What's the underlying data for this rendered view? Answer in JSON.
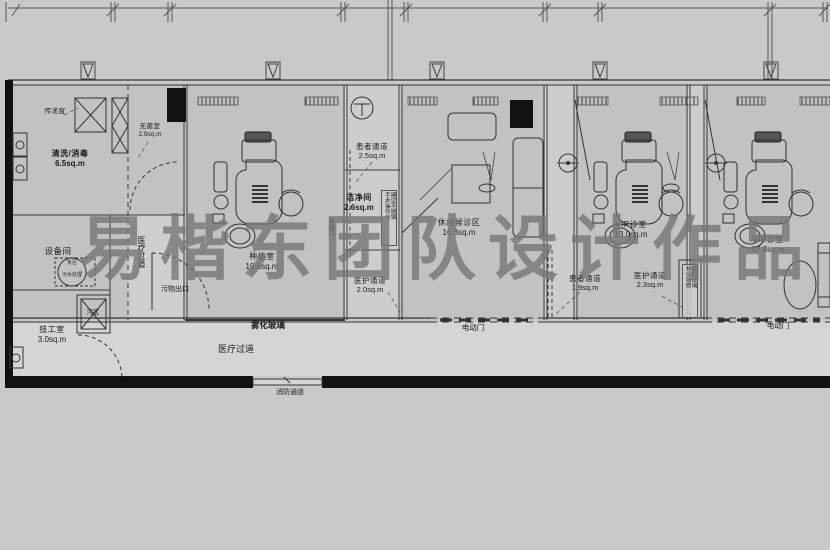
{
  "watermark": "易楷东团队设计作品",
  "colors": {
    "background": "#c9c9c9",
    "room_fill": "#c2c2c2",
    "corridor_fill": "#d5d5d5",
    "wall": "#111111",
    "line": "#3a3a3a",
    "watermark": "#767676"
  },
  "rooms": {
    "pass_window": {
      "name": "传递窗",
      "area": ""
    },
    "sterile": {
      "name": "无菌室",
      "area": "2.9sq.m"
    },
    "washing": {
      "name": "清洗/消毒",
      "area": "6.5sq.m"
    },
    "equipment": {
      "name": "设备间",
      "area": ""
    },
    "negative_pressure": {
      "name": "负压",
      "area": ""
    },
    "sewage": {
      "name": "污水处理",
      "area": ""
    },
    "dirty_zone": {
      "name": "污区",
      "area": ""
    },
    "technician": {
      "name": "技工室",
      "area": "3.0sq.m"
    },
    "implant": {
      "name": "种植室",
      "area": "19.6sq.m"
    },
    "patient_passage_1": {
      "name": "患者通道",
      "area": "2.5sq.m"
    },
    "clean_room": {
      "name": "洁净间",
      "area": "2.6sq.m"
    },
    "staff_passage_1": {
      "name": "医护通道",
      "area": "2.0sq.m"
    },
    "waiting": {
      "name": "休闲候诊区",
      "area": "16.8sq.m"
    },
    "patient_passage_2": {
      "name": "患者通道",
      "area": "1.9sq.m"
    },
    "vip_room_1": {
      "name": "VIP诊室",
      "area": "13.0sq.m"
    },
    "staff_passage_2": {
      "name": "医护通道",
      "area": "2.3sq.m"
    },
    "vip_room_2": {
      "name": "VIP诊室",
      "area": "17.8sq.m"
    }
  },
  "annotations": {
    "waste_exit": "污物出口",
    "fog_glass": "雾化玻璃",
    "medical_corridor": "医疗过道",
    "medical_corridor_vertical": "医疗过道",
    "fire_corridor": "消防通道",
    "electric_door_left": "电动门",
    "electric_door_right": "电动门",
    "foot_door": "脚踏门",
    "stainless_note_col1": "建议不锈钢",
    "stainless_note_col2": "手术操作台",
    "partition_note_col1": "磨砂玻璃",
    "partition_note_col2": "移动隔断"
  }
}
